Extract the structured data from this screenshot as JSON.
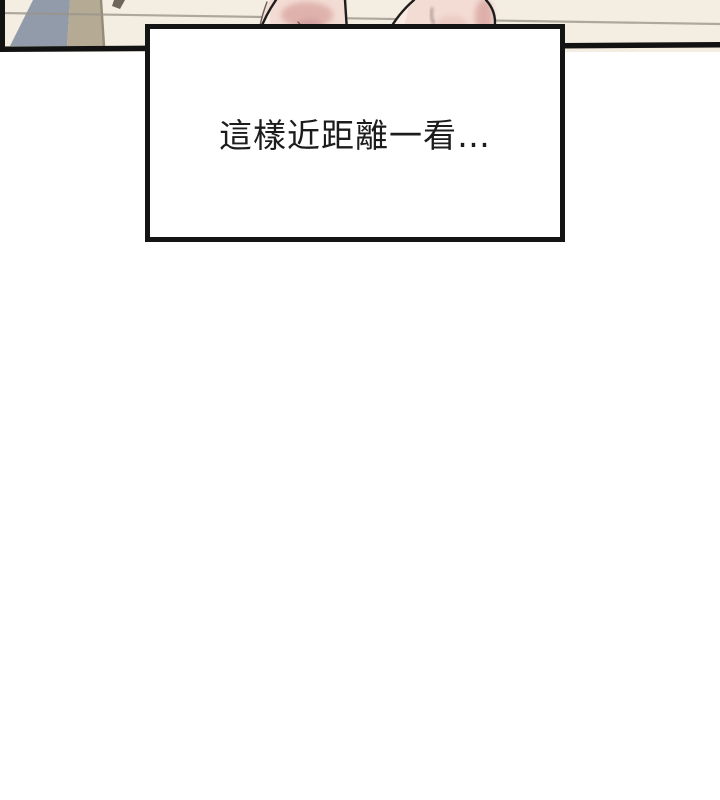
{
  "caption": {
    "text": "這樣近距離一看…"
  },
  "colors": {
    "page_background": "#ffffff",
    "wall": "#f4eee2",
    "rail_line": "#9b958c",
    "blue_wedge": "#929baa",
    "tan_pillar": "#b5aa93",
    "tan_pillar_edge": "#958b76",
    "small_object": "#6e6659",
    "skin_base": "#f3dcd4",
    "skin_light": "#f8ebe3",
    "skin_shadow": "#dcaba6",
    "skin_shadow_deep": "#cf9a9c",
    "panel_border": "#121212",
    "caption_border": "#141414",
    "caption_background": "#ffffff",
    "caption_text_color": "#1c1c1c"
  }
}
